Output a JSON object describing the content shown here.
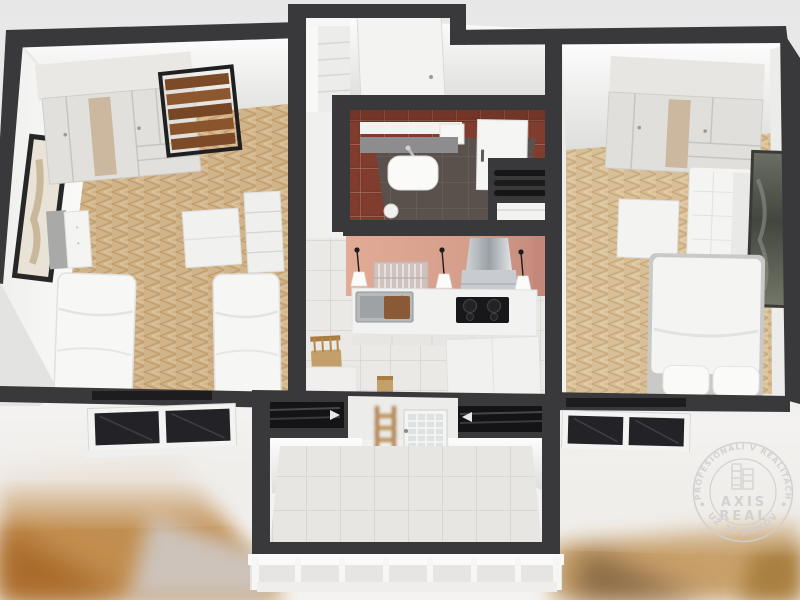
{
  "scene": {
    "type": "3d-apartment-floor-plan-render",
    "view": "top-down",
    "rooms": [
      {
        "name": "bedroom-left",
        "floor": "herringbone-oak",
        "furniture": [
          "wardrobe",
          "wood-slat-bench",
          "wall-art",
          "nightstand",
          "single-bed",
          "single-bed",
          "desk",
          "shelf-unit",
          "window"
        ]
      },
      {
        "name": "entry-hall",
        "floor": "white",
        "furniture": [
          "shelf-closet",
          "entrance-door"
        ]
      },
      {
        "name": "bathroom",
        "walls": "red-tiles",
        "furniture": [
          "wall-cabinet",
          "vanity-shelf",
          "counter",
          "washbasin",
          "faucet",
          "bathroom-door",
          "waste-bin",
          "vent-shaft",
          "washing-machine"
        ]
      },
      {
        "name": "kitchen",
        "walls": "salmon-pink",
        "floor": "white-tiles",
        "furniture": [
          "pendant-lamp",
          "pendant-lamp",
          "pendant-lamp",
          "glass-rack",
          "range-hood",
          "sink",
          "cutting-board",
          "cooktop",
          "counter",
          "dining-chair",
          "dining-table",
          "dining-chair",
          "cabinet"
        ]
      },
      {
        "name": "bedroom-right",
        "floor": "herringbone-oak-light",
        "furniture": [
          "wardrobe",
          "sofa",
          "wall-art",
          "side-table",
          "double-bed",
          "window"
        ]
      },
      {
        "name": "balcony",
        "floor": "white-tiles",
        "furniture": [
          "glazed-door",
          "wood-ladder",
          "railing"
        ]
      }
    ]
  },
  "watermark": {
    "arc_top": "PROFESIONÁLI V REALITÁCH",
    "arc_bottom": "UŽ 20 ROKOV",
    "brand_top": "AXIS",
    "brand_bottom": "REAL",
    "trademark": "™"
  },
  "palette": {
    "background": "#ececec",
    "wall_cut": "#3a3a3c",
    "interior_wall": "#f6f6f5",
    "floor_wood_left": "#d2b48a",
    "floor_wood_right": "#d8bf97",
    "bathroom_tile": "#7a392b",
    "kitchen_wall": "#d59e8b",
    "white_tile": "#ebe9e6",
    "backdrop_wood": "#c28e50",
    "watermark": "#cfcfcf"
  }
}
